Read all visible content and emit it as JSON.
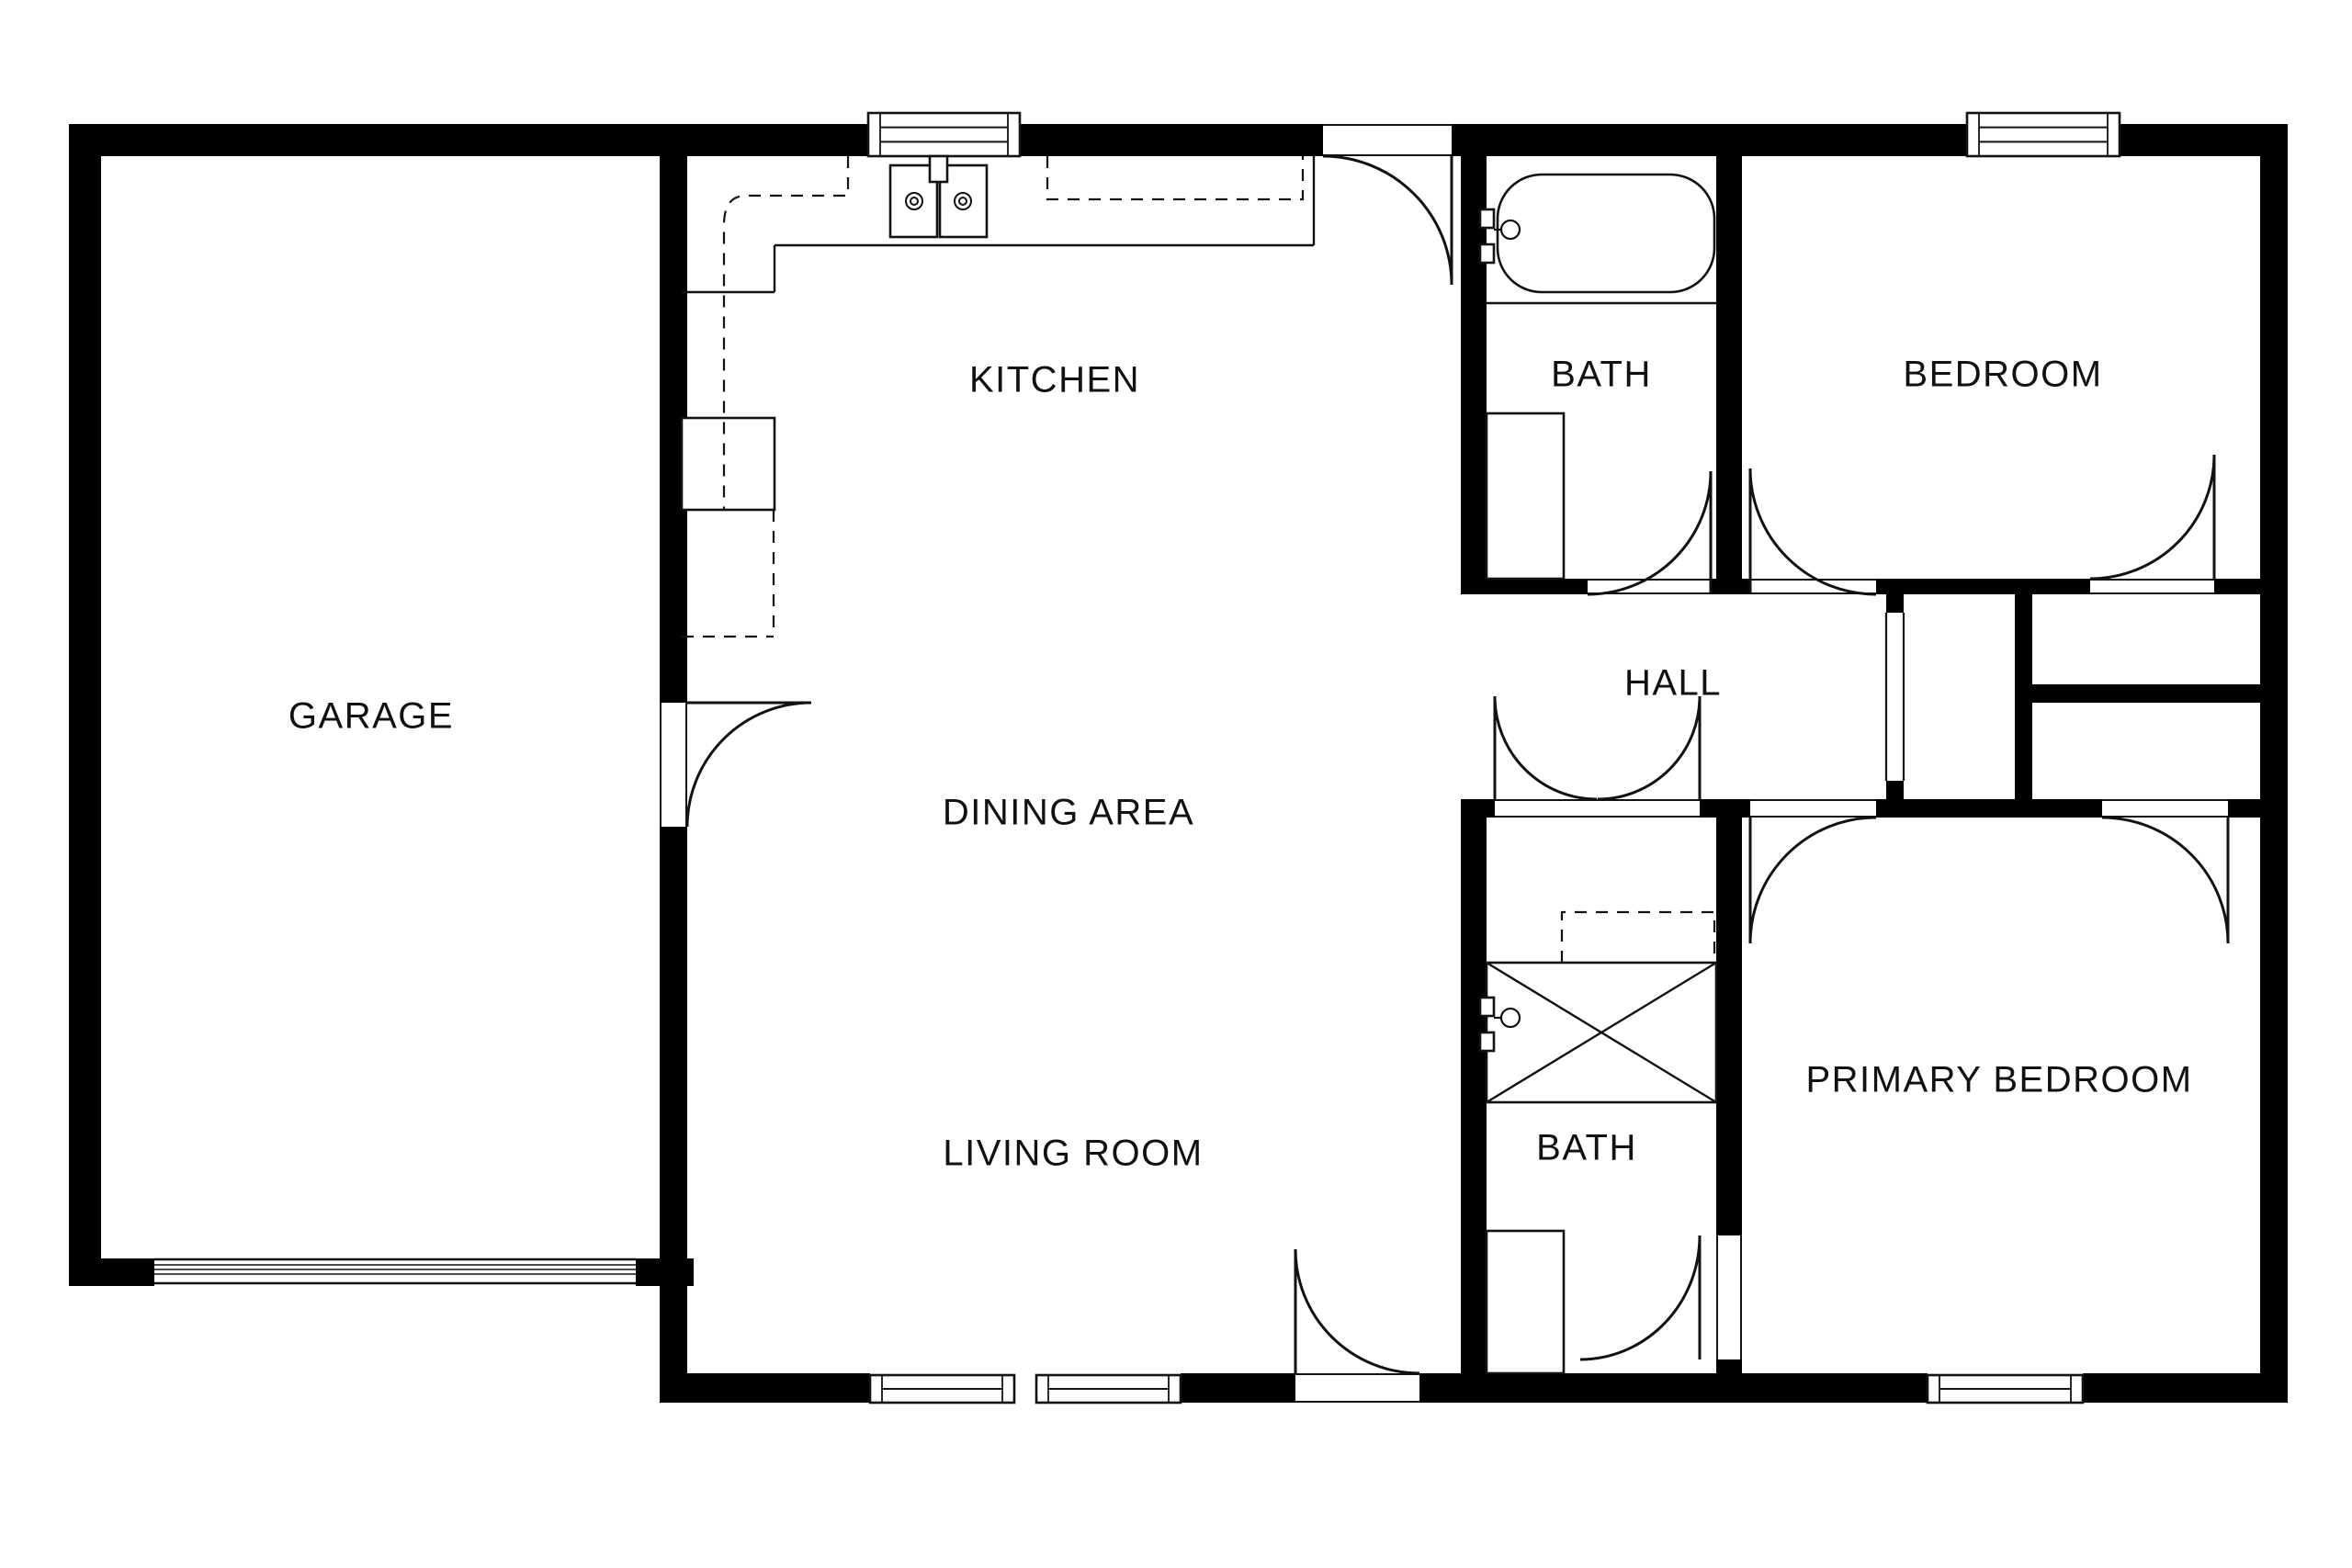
{
  "title": "Single-story house floor plan",
  "colors": {
    "wall": "#000000",
    "line": "#121212",
    "text": "#111111",
    "background": "#ffffff"
  },
  "rooms": {
    "garage": {
      "label": "GARAGE"
    },
    "kitchen": {
      "label": "KITCHEN"
    },
    "bath1": {
      "label": "BATH"
    },
    "bedroom": {
      "label": "BEDROOM"
    },
    "hall": {
      "label": "HALL"
    },
    "dining": {
      "label": "DINING AREA"
    },
    "living": {
      "label": "LIVING ROOM"
    },
    "bath2": {
      "label": "BATH"
    },
    "primary": {
      "label": "PRIMARY BEDROOM"
    }
  },
  "fixtures": [
    {
      "name": "bathtub-icon"
    },
    {
      "name": "tub-faucet-icon"
    },
    {
      "name": "shower-stall-icon"
    },
    {
      "name": "shower-faucet-icon"
    },
    {
      "name": "double-kitchen-sink-icon"
    },
    {
      "name": "kitchen-counter"
    },
    {
      "name": "stove-icon"
    },
    {
      "name": "bath-vanity-icon"
    },
    {
      "name": "garage-door-icon"
    },
    {
      "name": "window-icon"
    },
    {
      "name": "door-swing-icon"
    }
  ]
}
